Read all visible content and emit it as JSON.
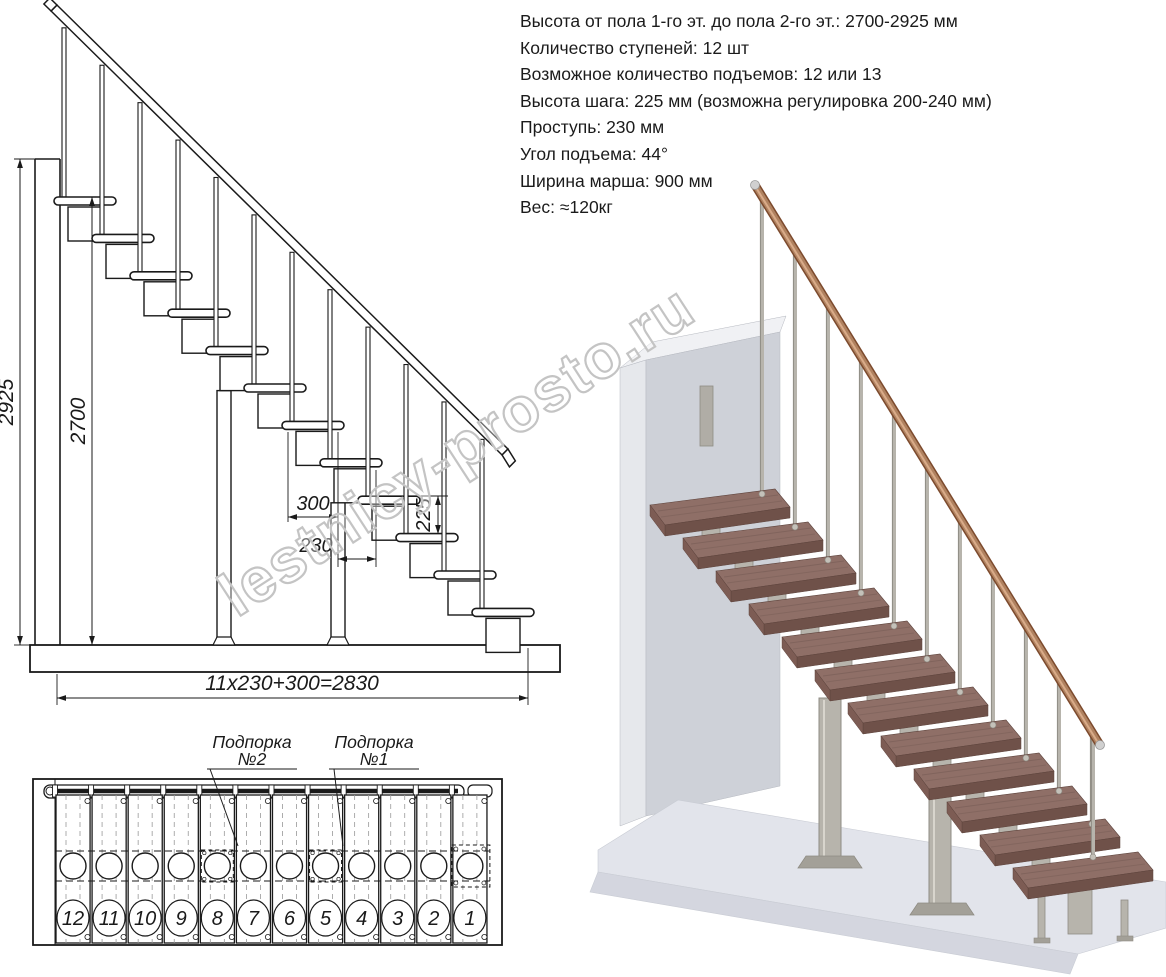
{
  "page": {
    "background": "#ffffff",
    "ink": "#1a1a1a"
  },
  "specs": {
    "lines": [
      "Высота от пола 1-го эт. до пола 2-го эт.: 2700-2925 мм",
      "Количество ступеней: 12 шт",
      "Возможное количество подъемов: 12 или 13",
      "Высота шага: 225 мм (возможна регулировка 200-240 мм)",
      "Проступь: 230 мм",
      "Угол подъема: 44°",
      "Ширина марша: 900 мм",
      "Вес: ≈120кг"
    ]
  },
  "side_view": {
    "dimensions": {
      "total_height": "2925",
      "clear_height": "2700",
      "tread_depth": "300",
      "going": "230",
      "riser": "225",
      "total_run": "11x230+300=2830"
    }
  },
  "plan_view": {
    "step_numbers": [
      "12",
      "11",
      "10",
      "9",
      "8",
      "7",
      "6",
      "5",
      "4",
      "3",
      "2",
      "1"
    ],
    "callouts": [
      {
        "line1": "Подпорка",
        "line2": "№2",
        "target_step": "8"
      },
      {
        "line1": "Подпорка",
        "line2": "№1",
        "target_step": "5"
      }
    ]
  },
  "watermark": {
    "text": "lestnicy-prosto.ru"
  },
  "render_3d": {
    "colors": {
      "tread": "#8f6f67",
      "tread_front": "#6f5149",
      "tread_side": "#7d5c54",
      "metal": "#b7b4ac",
      "metal_dark": "#8f8c84",
      "metal_light": "#d8d5cd",
      "rail": "#b08260",
      "rail_dark": "#7c4a2d",
      "rail_light": "#d9ab89",
      "ferrule": "#d0d0d0",
      "wall_front": "#ced1d8",
      "wall_side": "#e6e8ec",
      "wall_top": "#f0f1f4",
      "floor_top": "#e2e4eb",
      "floor_front": "#d4d6df",
      "foot": "#a3a098"
    }
  }
}
